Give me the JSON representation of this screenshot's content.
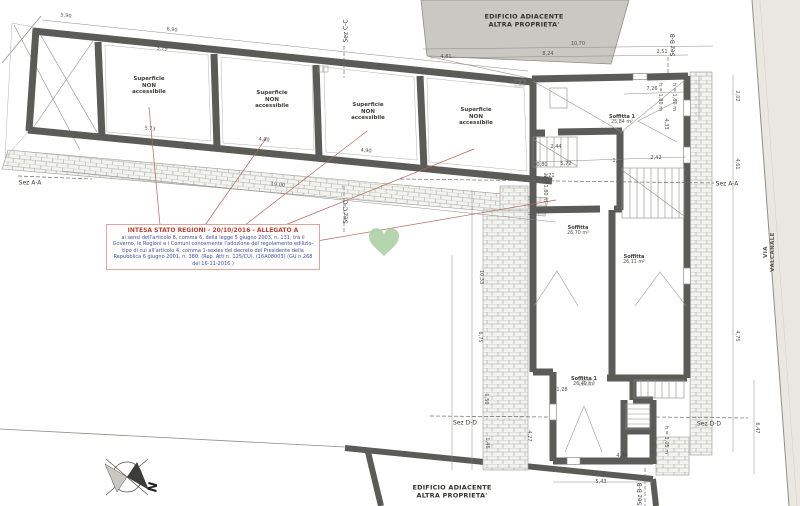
{
  "drawing": {
    "type": "architectural floor plan (attic level)",
    "colors": {
      "wall": "#5b5b58",
      "adjacent_fill": "#c9c8c3",
      "road_fill": "#eae7e2",
      "brick_line": "#a9a9a2",
      "legend_title": "#b04438",
      "legend_body": "#3d52a0",
      "leader_line": "#b2675c",
      "heart": "#aecfa5"
    }
  },
  "legend": {
    "title": "INTESA STATO REGIONI - 20/10/2016 - ALLEGATO A",
    "body": "ai sensi dell'articolo 8, comma 6, della legge 5 giugno 2003, n. 131, tra il Governo, le Regioni e i Comuni concernente l'adozione del regolamento edilizio-tipo di cui all'articolo 4, comma 1-sexies del decreto del Presidente della Repubblica 6 giugno 2001, n. 380. (Rep. Atti n. 125/CU). (16A08003) (GU n.268 del 16-11-2016 )"
  },
  "adjacent": {
    "top_label": "EDIFICIO ADIACENTE\nALTRA PROPRIETA'",
    "bottom_label": "EDIFICIO ADIACENTE\nALTRA PROPRIETA'"
  },
  "street": {
    "name": "VIA\nVALCANALE"
  },
  "compass": {
    "north_label": "N"
  },
  "wing": {
    "room_label": "Superficie\nNON\naccessibile",
    "room_label_positions": [
      {
        "x": 149,
        "y": 86
      },
      {
        "x": 272,
        "y": 100
      },
      {
        "x": 368,
        "y": 112
      },
      {
        "x": 476,
        "y": 117
      }
    ]
  },
  "rooms": [
    {
      "name": "Soffitta 1",
      "area": "25,84 m²",
      "x": 622,
      "y": 120
    },
    {
      "name": "Soffitta",
      "area": "26,70 m²",
      "x": 578,
      "y": 231
    },
    {
      "name": "Soffitta",
      "area": "26,11 m²",
      "x": 634,
      "y": 260
    },
    {
      "name": "Soffitta 1",
      "area": "26,49 m²",
      "x": 584,
      "y": 382
    }
  ],
  "sections": [
    {
      "t": "Sez C-C",
      "x": 346,
      "y": 31,
      "r": -90
    },
    {
      "t": "Sez B-B",
      "x": 673,
      "y": 45,
      "r": -90
    },
    {
      "t": "Sez C-C",
      "x": 346,
      "y": 212,
      "r": -90
    },
    {
      "t": "Sez A-A",
      "x": 30,
      "y": 183,
      "r": 0
    },
    {
      "t": "Sez A-A",
      "x": 727,
      "y": 184,
      "r": 0
    },
    {
      "t": "Sez D-D",
      "x": 465,
      "y": 423,
      "r": 0
    },
    {
      "t": "Sez D-D",
      "x": 709,
      "y": 424,
      "r": 0
    },
    {
      "t": "Sez B-B",
      "x": 640,
      "y": 494,
      "r": -90
    }
  ],
  "dimensions": [
    {
      "t": "5,90",
      "x": 66,
      "y": 16,
      "r": 6
    },
    {
      "t": "6,90",
      "x": 172,
      "y": 30,
      "r": 6
    },
    {
      "t": "3,79",
      "x": 162,
      "y": 49,
      "r": 6
    },
    {
      "t": "5,73",
      "x": 150,
      "y": 129,
      "r": 6
    },
    {
      "t": "4,80",
      "x": 264,
      "y": 140,
      "r": 6
    },
    {
      "t": "4,90",
      "x": 366,
      "y": 151,
      "r": 6
    },
    {
      "t": "19,00",
      "x": 278,
      "y": 185,
      "r": 6
    },
    {
      "t": "10,70",
      "x": 578,
      "y": 44,
      "r": 0
    },
    {
      "t": "8,24",
      "x": 548,
      "y": 54,
      "r": 0
    },
    {
      "t": "4,81",
      "x": 446,
      "y": 57,
      "r": 0
    },
    {
      "t": "2,51",
      "x": 662,
      "y": 52,
      "r": 0
    },
    {
      "t": "7,26",
      "x": 652,
      "y": 89,
      "r": 0
    },
    {
      "t": "4,33",
      "x": 666,
      "y": 124,
      "r": 90
    },
    {
      "t": "2,02",
      "x": 737,
      "y": 96,
      "r": 90
    },
    {
      "t": "4,61",
      "x": 737,
      "y": 164,
      "r": 90
    },
    {
      "t": "4,75",
      "x": 737,
      "y": 336,
      "r": 90
    },
    {
      "t": "0,80",
      "x": 542,
      "y": 165,
      "r": 0
    },
    {
      "t": "5,72",
      "x": 566,
      "y": 164,
      "r": 0
    },
    {
      "t": "2,44",
      "x": 556,
      "y": 147,
      "r": 0
    },
    {
      "t": "1,10",
      "x": 618,
      "y": 161,
      "r": 0
    },
    {
      "t": "2,42",
      "x": 656,
      "y": 158,
      "r": 0
    },
    {
      "t": "1,21",
      "x": 549,
      "y": 176,
      "r": 0
    },
    {
      "t": "10,33",
      "x": 481,
      "y": 277,
      "r": 90
    },
    {
      "t": "6,75",
      "x": 480,
      "y": 337,
      "r": 90
    },
    {
      "t": "1,50",
      "x": 486,
      "y": 399,
      "r": 90
    },
    {
      "t": "1,46",
      "x": 487,
      "y": 443,
      "r": 90
    },
    {
      "t": "4,27",
      "x": 529,
      "y": 436,
      "r": 90
    },
    {
      "t": "1,28",
      "x": 562,
      "y": 390,
      "r": 0
    },
    {
      "t": "4,44",
      "x": 622,
      "y": 456,
      "r": 0
    },
    {
      "t": "5,43",
      "x": 601,
      "y": 482,
      "r": 0
    },
    {
      "t": "6,47",
      "x": 757,
      "y": 428,
      "r": 90
    },
    {
      "t": "h = 1,80 m",
      "x": 660,
      "y": 97,
      "r": 90
    },
    {
      "t": "h = 1,80 m",
      "x": 674,
      "y": 97,
      "r": 90
    },
    {
      "t": "h = 1,80 m",
      "x": 545,
      "y": 188,
      "r": 90
    },
    {
      "t": "h = 1,80 m",
      "x": 652,
      "y": 440,
      "r": 90
    },
    {
      "t": "h = 1,05 m",
      "x": 666,
      "y": 440,
      "r": 90
    }
  ]
}
